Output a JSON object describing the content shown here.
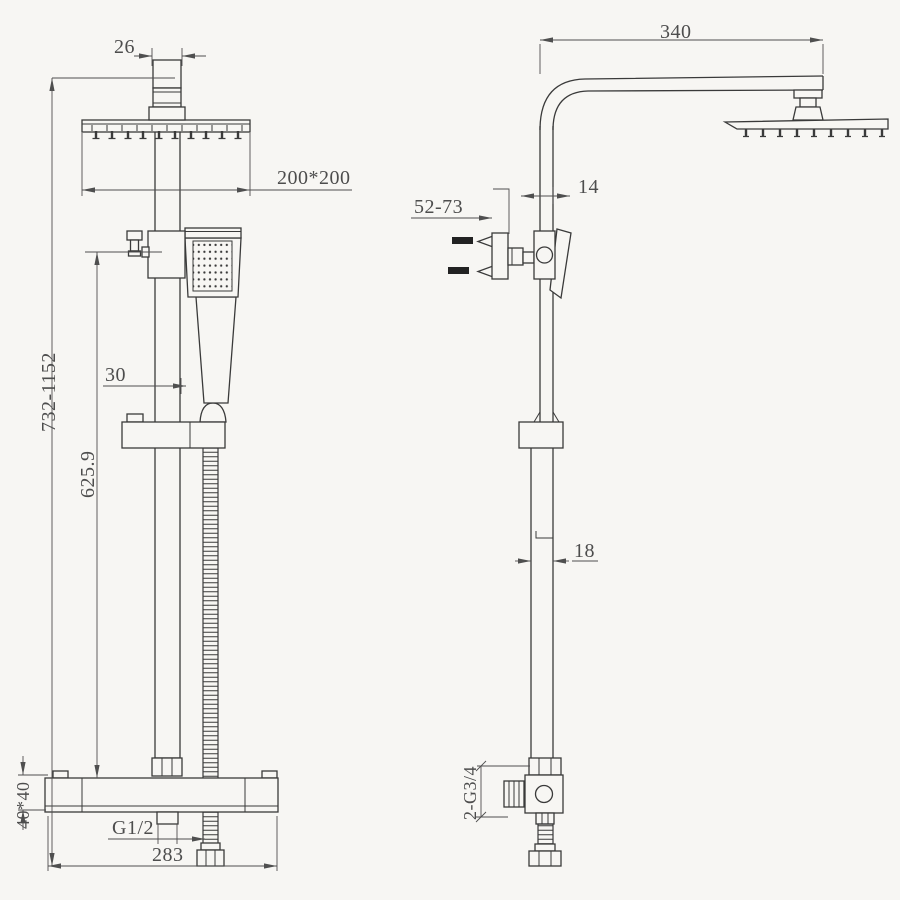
{
  "drawing": {
    "type": "technical-dimension-drawing",
    "subject": "thermostatic shower column with square rain head and hand shower, front and side views",
    "colors": {
      "background": "#f7f6f3",
      "line": "#3a3a3a",
      "dimension": "#4d4d4d"
    }
  },
  "views": {
    "front": {
      "dims": {
        "head_pipe": "26",
        "head_size": "200*200",
        "handshower_offset": "30",
        "total_height": "732-1152",
        "rail_height": "625.9",
        "valve_body": "40*40",
        "outlet_thread": "G1/2",
        "valve_width": "283"
      }
    },
    "side": {
      "dims": {
        "arm_length": "340",
        "upper_pipe_width": "14",
        "wall_distance": "52-73",
        "lower_pipe_width": "18",
        "inlet_thread": "2-G3/4"
      }
    }
  }
}
